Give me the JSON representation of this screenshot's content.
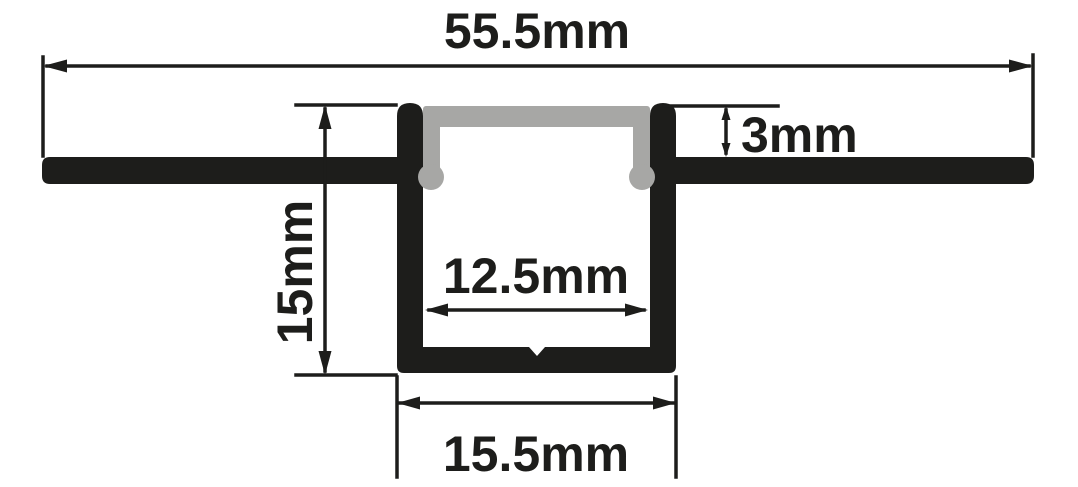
{
  "colors": {
    "profile": "#1d1d1b",
    "diffuser": "#a7a7a5",
    "dimension": "#1d1d1b",
    "text": "#1d1d1b",
    "background": "#ffffff"
  },
  "dimensions": {
    "overall_width": {
      "label": "55.5mm",
      "value_mm": 55.5
    },
    "recess_depth": {
      "label": "3mm",
      "value_mm": 3
    },
    "profile_height": {
      "label": "15mm",
      "value_mm": 15
    },
    "inner_width": {
      "label": "12.5mm",
      "value_mm": 12.5
    },
    "outer_width": {
      "label": "15.5mm",
      "value_mm": 15.5
    }
  }
}
